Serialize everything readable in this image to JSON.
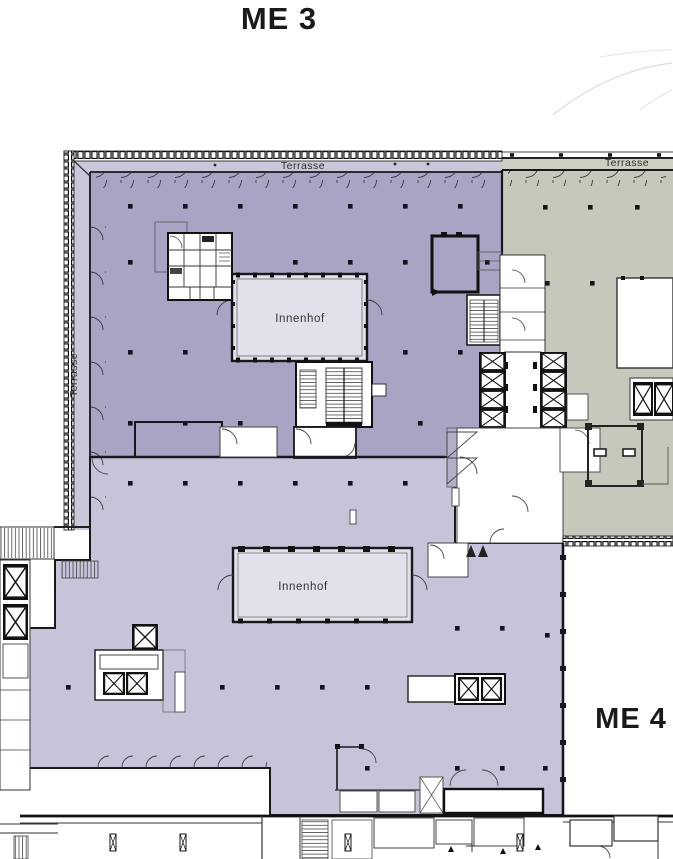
{
  "units": {
    "me3": "ME 3",
    "me4": "ME 4"
  },
  "labels": {
    "terrasse_top_me3": "Terrasse",
    "terrasse_top_me4": "Terrasse",
    "terrasse_left": "Terrasse",
    "innenhof_upper": "Innenhof",
    "innenhof_lower": "Innenhof"
  },
  "colors": {
    "me3_upper_zone": "#a8a4c3",
    "me3_lower_zone": "#c7c4d9",
    "me4_zone": "#c6c8bb",
    "courtyard": "#e2e1eb",
    "terrace_strip_me3": "#cac7db",
    "terrace_strip_me4": "#cdcfc3",
    "escalator_zone": "#b3afc9",
    "wall": "#17171d"
  }
}
